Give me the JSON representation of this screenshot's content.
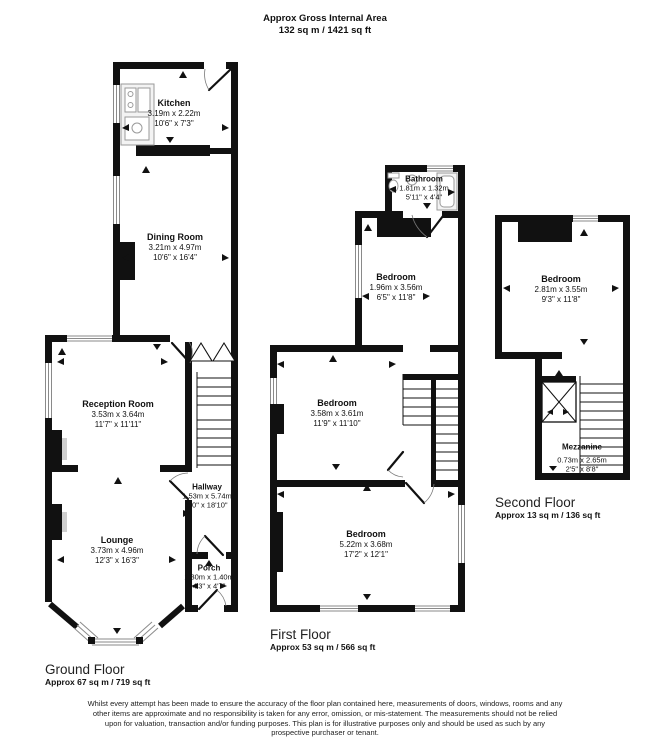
{
  "header": {
    "title": "Approx Gross Internal Area",
    "subtitle": "132 sq m / 1421 sq ft"
  },
  "floors": {
    "ground": {
      "label": "Ground Floor",
      "area": "Approx 67 sq m / 719 sq ft",
      "rooms": {
        "kitchen": {
          "name": "Kitchen",
          "metric": "3.19m x 2.22m",
          "imperial": "10'6\" x 7'3\""
        },
        "dining_room": {
          "name": "Dining Room",
          "metric": "3.21m x 4.97m",
          "imperial": "10'6\" x 16'4\""
        },
        "reception_room": {
          "name": "Reception Room",
          "metric": "3.53m x 3.64m",
          "imperial": "11'7\" x 11'11\""
        },
        "hallway": {
          "name": "Hallway",
          "metric": "1.53m x 5.74m",
          "imperial": "5'0\" x 18'10\""
        },
        "lounge": {
          "name": "Lounge",
          "metric": "3.73m x 4.96m",
          "imperial": "12'3\" x 16'3\""
        },
        "porch": {
          "name": "Porch",
          "metric": "1.30m x 1.40m",
          "imperial": "4'3\" x 4'7\""
        }
      }
    },
    "first": {
      "label": "First Floor",
      "area": "Approx 53 sq m / 566 sq ft",
      "rooms": {
        "bathroom": {
          "name": "Bathroom",
          "metric": "1.81m x 1.32m",
          "imperial": "5'11\" x 4'4\""
        },
        "bedroom_rear": {
          "name": "Bedroom",
          "metric": "1.96m x 3.56m",
          "imperial": "6'5\" x 11'8\""
        },
        "bedroom_middle": {
          "name": "Bedroom",
          "metric": "3.58m x 3.61m",
          "imperial": "11'9\" x 11'10\""
        },
        "bedroom_front": {
          "name": "Bedroom",
          "metric": "5.22m x 3.68m",
          "imperial": "17'2\" x 12'1\""
        }
      }
    },
    "second": {
      "label": "Second Floor",
      "area": "Approx 13 sq m / 136 sq ft",
      "rooms": {
        "bedroom": {
          "name": "Bedroom",
          "metric": "2.81m x 3.55m",
          "imperial": "9'3\" x 11'8\""
        },
        "mezzanine": {
          "name": "Mezzanine",
          "metric": "0.73m x 2.65m",
          "imperial": "2'5\" x 8'8\""
        }
      }
    }
  },
  "disclaimer": "Whilst every attempt has been made to ensure the accuracy of the floor plan contained here, measurements of doors, windows, rooms and any other items are approximate and no responsibility is taken for any error, omission, or mis-statement. The measurements should not be relied upon for valuation, transaction and/or funding purposes. This plan is for illustrative purposes only and should be used as such by any prospective purchaser or tenant.",
  "colors": {
    "wall": "#111111",
    "window_line": "#8a8a8a",
    "background": "#ffffff"
  }
}
